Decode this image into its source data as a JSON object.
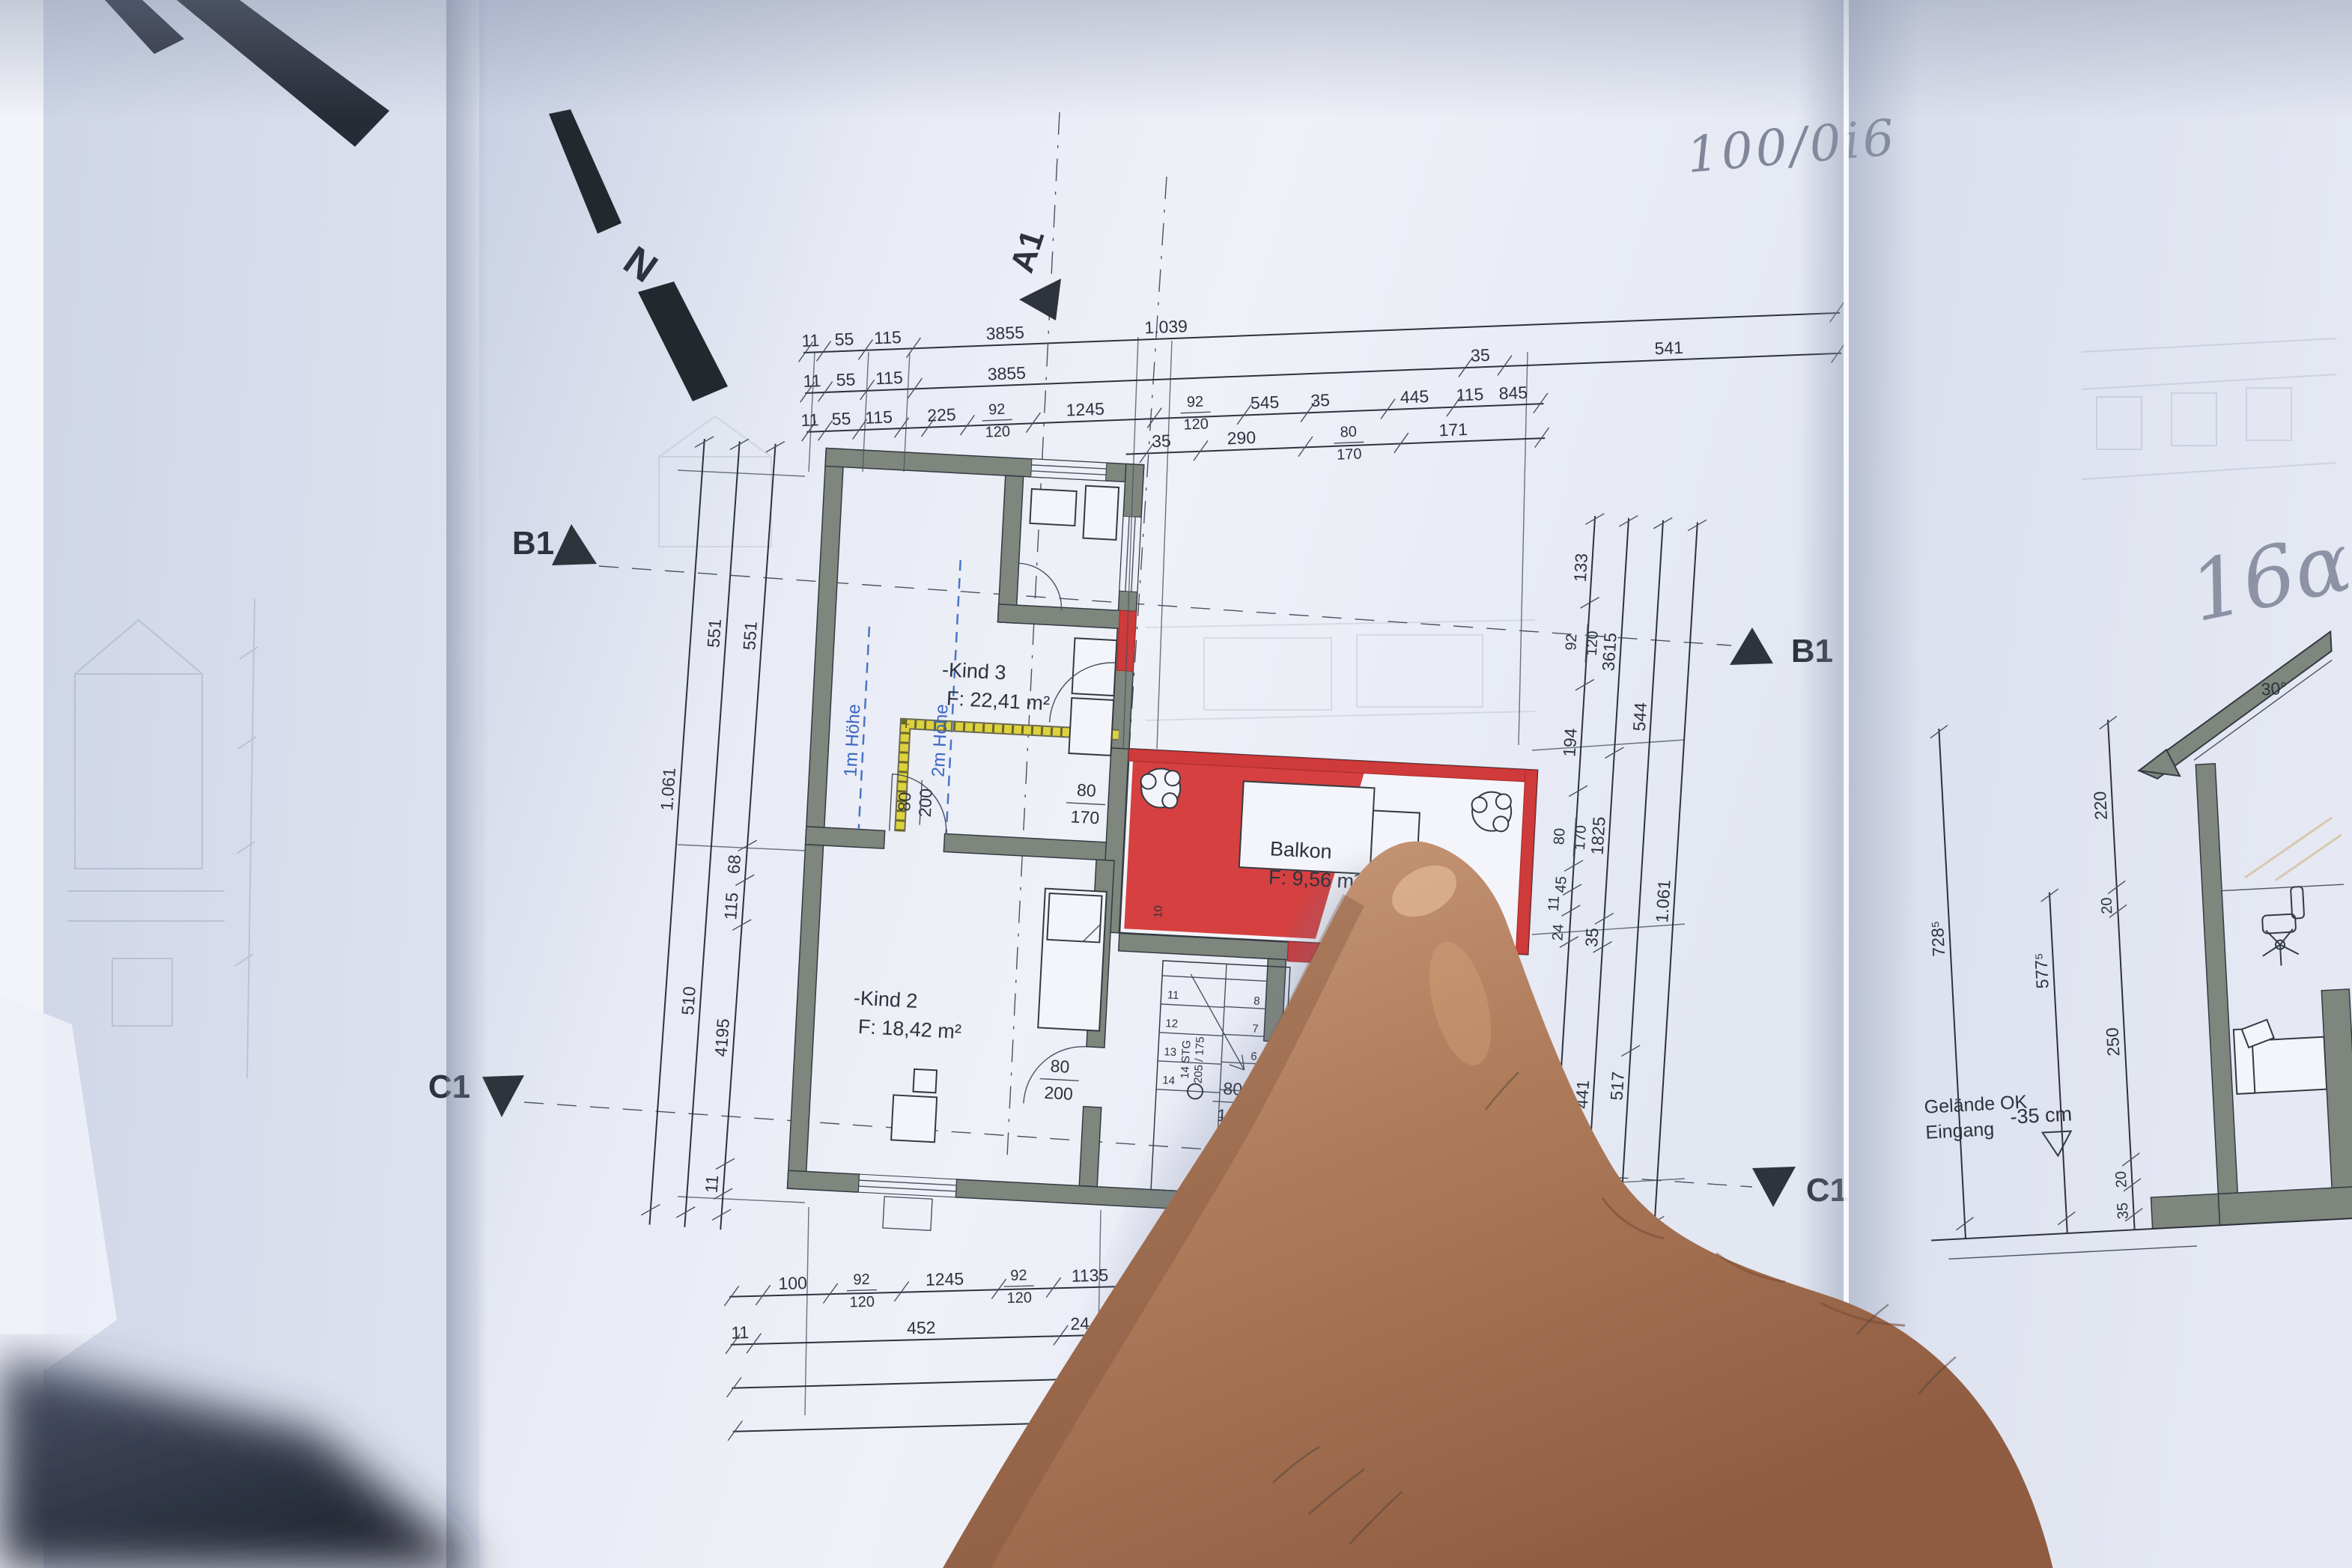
{
  "annotations": {
    "top": "100/0i6",
    "right": "16α"
  },
  "north": "N",
  "markers": {
    "a1": "A1",
    "b1": "B1",
    "c1": "C1"
  },
  "rooms": {
    "kind3": {
      "name": "-Kind 3",
      "area": "F: 22,41 m²"
    },
    "kind2": {
      "name": "-Kind 2",
      "area": "F: 18,42 m²"
    },
    "kind1": {
      "name": "-Kind 1",
      "area": "F: 13,60 m²"
    },
    "balkon": {
      "name": "Balkon",
      "area": "F: 9,56 m²"
    }
  },
  "heights": [
    "1m Höhe",
    "2m Höhe"
  ],
  "doors": {
    "k3": {
      "w": "80",
      "h": "170"
    },
    "upper": {
      "w": "80",
      "h": "200"
    },
    "balkon": {
      "w": "80",
      "h": "170"
    },
    "k2": {
      "w": "80",
      "h": "200"
    },
    "k1": {
      "w": "80",
      "h": "190"
    }
  },
  "stair": {
    "l1": "14 STG",
    "l2": "205 / 175",
    "ten": "10",
    "steps_upper": [
      "11",
      "12",
      "13",
      "14"
    ],
    "steps_lower": [
      "1",
      "2",
      "3",
      "4",
      "5",
      "6",
      "7",
      "8"
    ]
  },
  "dims": {
    "t1": [
      "11",
      "55",
      "115",
      "3855",
      "1.039"
    ],
    "t2": [
      "11",
      "55",
      "115",
      "3855",
      "35",
      "541"
    ],
    "t3": [
      "11",
      "55",
      "115",
      "225",
      "92",
      "120",
      "1245",
      "92",
      "120",
      "545",
      "35",
      "445",
      "115",
      "845"
    ],
    "t4": [
      "35",
      "290",
      "80",
      "170",
      "171"
    ],
    "left": [
      "1.061",
      "551",
      "510",
      "551",
      "68",
      "115",
      "4195",
      "11"
    ],
    "rA": [
      "133",
      "92",
      "120",
      "194",
      "80",
      "170",
      "45",
      "11",
      "24",
      "441"
    ],
    "rB": [
      "3615",
      "1825",
      "35",
      "441"
    ],
    "rC": [
      "544",
      "517"
    ],
    "rD": [
      "1.061"
    ],
    "b1": [
      "100",
      "92",
      "120",
      "1245",
      "92",
      "120",
      "1135",
      "86",
      "190",
      "1265",
      "92",
      "120",
      "16"
    ],
    "b2": [
      "11",
      "452",
      "24",
      "155",
      "15",
      "3365"
    ],
    "b3": [
      "9935"
    ],
    "b4": [
      "1.039"
    ]
  },
  "section": {
    "angle": "30°",
    "d728": "728⁵",
    "d577": "577⁵",
    "d220": "220",
    "d250": "250",
    "d20a": "20",
    "d20b": "20",
    "d35": "35",
    "g1": "Gelände OK",
    "g2": "Eingang",
    "g3": "-35 cm"
  },
  "colors": {
    "accent_red": "#cf3a3a",
    "insulation_yellow": "#ddd23e",
    "height_blue": "#3a66c4",
    "wall_grey": "#7e867d"
  }
}
